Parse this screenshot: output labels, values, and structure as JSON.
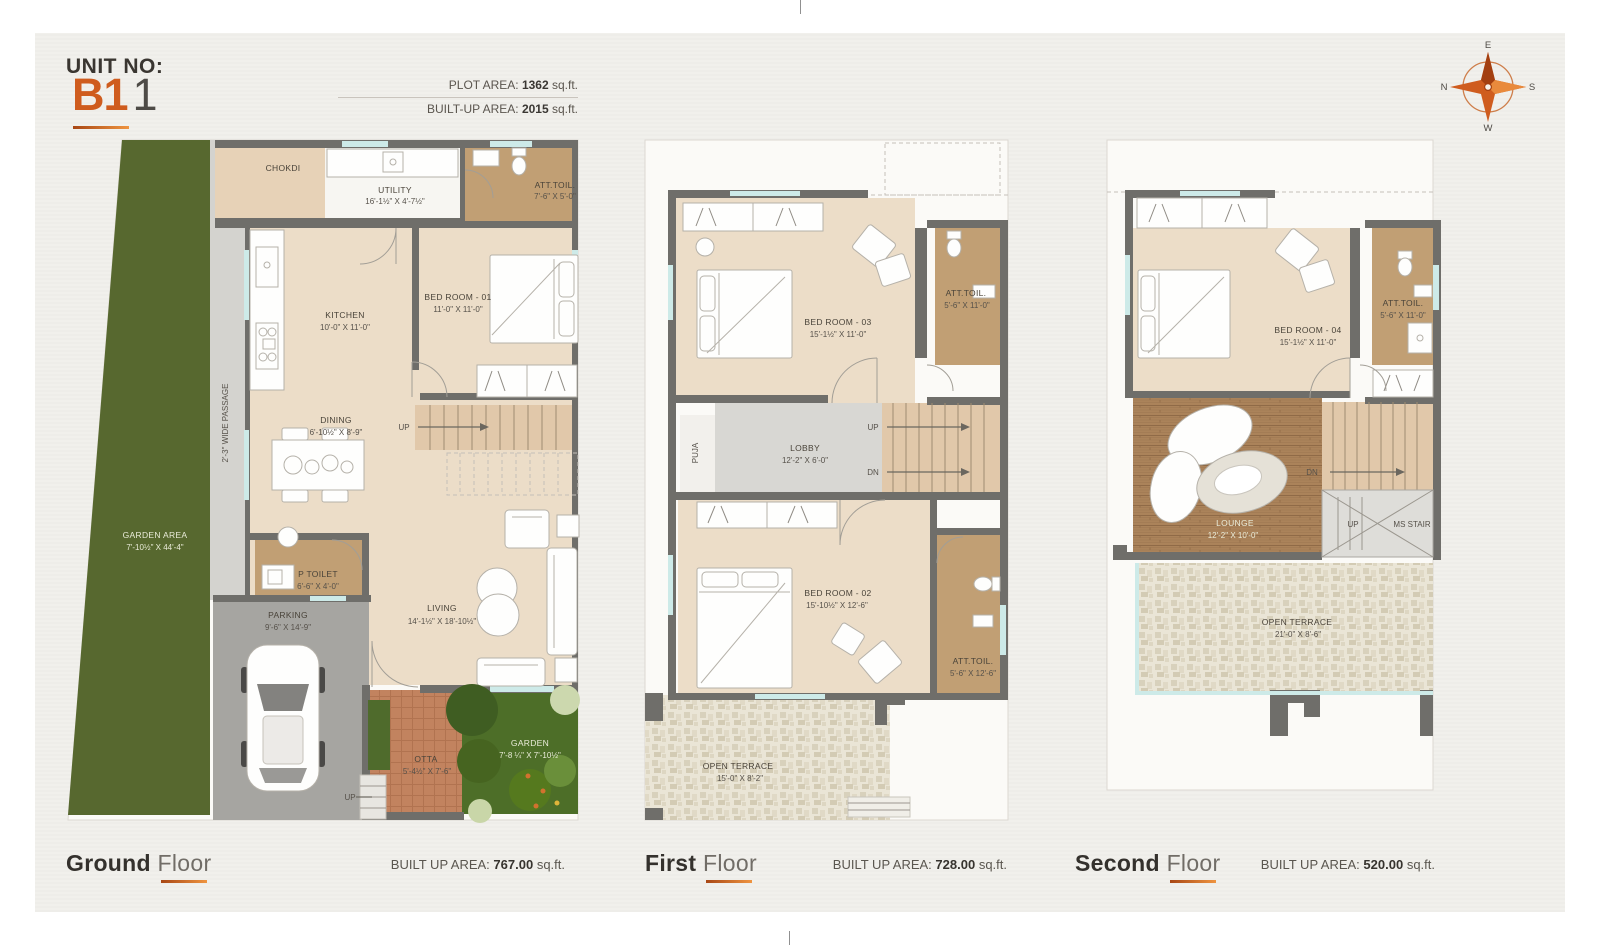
{
  "header": {
    "unit_label": "UNIT NO:",
    "unit_primary": "B1",
    "unit_secondary": "1",
    "plot_area_label": "PLOT AREA:",
    "plot_area_value": "1362",
    "builtup_label": "BUILT-UP AREA:",
    "builtup_value": "2015",
    "area_unit": "sq.ft."
  },
  "compass": {
    "n": "N",
    "e": "E",
    "s": "S",
    "w": "W"
  },
  "floors": [
    {
      "title_bold": "Ground",
      "title_light": "Floor",
      "area_label": "BUILT UP AREA:",
      "area_value": "767.00",
      "area_unit": "sq.ft.",
      "rooms": {
        "garden_area": {
          "label": "GARDEN AREA",
          "dims": "7'-10½\" X 44'-4\""
        },
        "passage": {
          "label": "2'-3\" WIDE PASSAGE"
        },
        "chokdi": {
          "label": "CHOKDI"
        },
        "utility": {
          "label": "UTILITY",
          "dims": "16'-1½\" X 4'-7½\""
        },
        "att_toilet": {
          "label": "ATT.TOIL.",
          "dims": "7'-6\" X 5'-0\""
        },
        "kitchen": {
          "label": "KITCHEN",
          "dims": "10'-0\" X 11'-0\""
        },
        "bedroom_01": {
          "label": "BED ROOM - 01",
          "dims": "11'-0\" X 11'-0\""
        },
        "dining": {
          "label": "DINING",
          "dims": "6'-10½\" X 8'-9\""
        },
        "stair_up": {
          "label": "UP"
        },
        "p_toilet": {
          "label": "P TOILET",
          "dims": "6'-6\" X 4'-0\""
        },
        "living": {
          "label": "LIVING",
          "dims": "14'-1½\" X 18'-10½\""
        },
        "parking": {
          "label": "PARKING",
          "dims": "9'-6\" X 14'-9\""
        },
        "otta": {
          "label": "OTTA",
          "dims": "5'-4½\" X 7'-6\""
        },
        "garden": {
          "label": "GARDEN",
          "dims": "7'-8 ¼\" X 7'-10½\""
        },
        "entry_up": {
          "label": "UP"
        }
      }
    },
    {
      "title_bold": "First",
      "title_light": "Floor",
      "area_label": "BUILT UP AREA:",
      "area_value": "728.00",
      "area_unit": "sq.ft.",
      "rooms": {
        "bedroom_03": {
          "label": "BED ROOM - 03",
          "dims": "15'-1½\" X 11'-0\""
        },
        "att_toilet_top": {
          "label": "ATT.TOIL.",
          "dims": "5'-6\" X 11'-0\""
        },
        "puja": {
          "label": "PUJA"
        },
        "lobby": {
          "label": "LOBBY",
          "dims": "12'-2\" X 6'-0\""
        },
        "stair_up": {
          "label": "UP"
        },
        "stair_dn": {
          "label": "DN"
        },
        "bedroom_02": {
          "label": "BED ROOM - 02",
          "dims": "15'-10½\" X 12'-6\""
        },
        "att_toilet_bottom": {
          "label": "ATT.TOIL.",
          "dims": "5'-6\" X 12'-6\""
        },
        "open_terrace": {
          "label": "OPEN TERRACE",
          "dims": "15'-0\" X 8'-2\""
        }
      }
    },
    {
      "title_bold": "Second",
      "title_light": "Floor",
      "area_label": "BUILT UP AREA:",
      "area_value": "520.00",
      "area_unit": "sq.ft.",
      "rooms": {
        "bedroom_04": {
          "label": "BED ROOM - 04",
          "dims": "15'-1½\" X 11'-0\""
        },
        "att_toilet": {
          "label": "ATT.TOIL.",
          "dims": "5'-6\" X 11'-0\""
        },
        "lounge": {
          "label": "LOUNGE",
          "dims": "12'-2\" X 10'-0\""
        },
        "stair_dn": {
          "label": "DN"
        },
        "stair_up": {
          "label": "UP"
        },
        "ms_stair": {
          "label": "MS STAIR"
        },
        "open_terrace": {
          "label": "OPEN TERRACE",
          "dims": "21'-0\" X 8'-6\""
        }
      }
    }
  ],
  "colors": {
    "accent_orange": "#cf5c1e",
    "wall": "#6f6e6a",
    "garden": "#57682f"
  }
}
